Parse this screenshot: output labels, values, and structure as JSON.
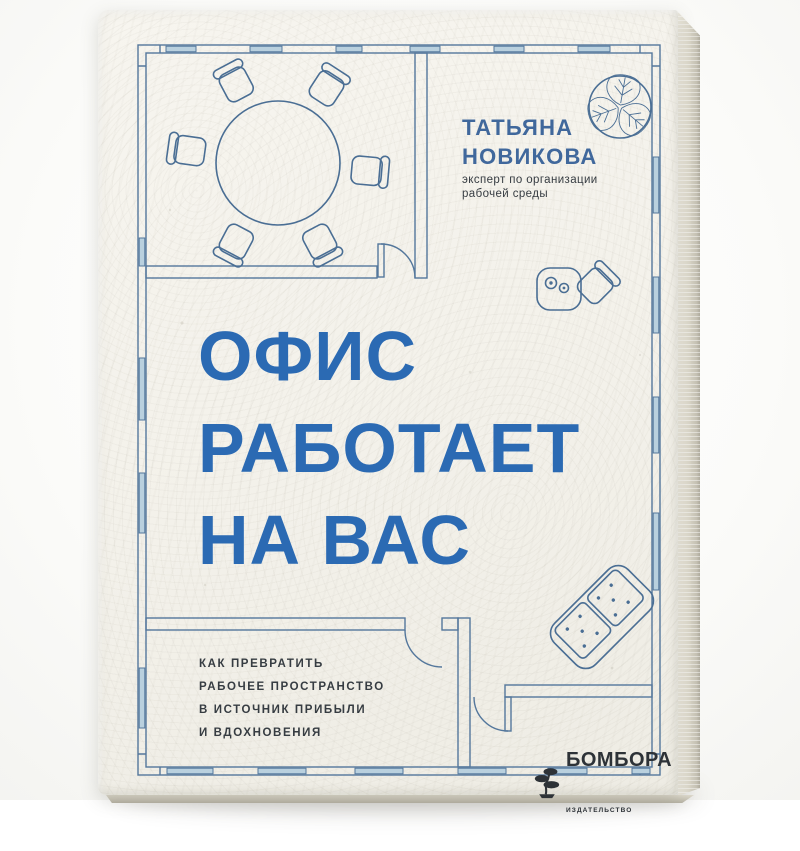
{
  "book_cover": {
    "author": {
      "name": [
        "ТАТЬЯНА",
        "НОВИКОВА"
      ],
      "role": [
        "эксперт по организации",
        "рабочей среды"
      ]
    },
    "title": [
      "ОФИС",
      "РАБОТАЕТ",
      "НА ВАС"
    ],
    "tagline": [
      "КАК ПРЕВРАТИТЬ",
      "РАБОЧЕЕ ПРОСТРАНСТВО",
      "В ИСТОЧНИК ПРИБЫЛИ",
      "И ВДОХНОВЕНИЯ"
    ],
    "publisher": {
      "name": "БОМБОРА",
      "descriptor": "ИЗДАТЕЛЬСТВО"
    },
    "colors": {
      "title_blue": "#2b6ab3",
      "author_blue": "#40689c",
      "plan_line": "#54779c",
      "furn_line": "#4a6e94",
      "window_fill": "#b9d0de",
      "text_dark": "#363c42",
      "publisher_dark": "#2d3237",
      "paper": "#f3f1ea"
    },
    "icons": [
      "plant-top-view-icon",
      "round-table-icon",
      "office-chair-icon",
      "desk-icon",
      "sofa-icon",
      "door-arc-icon",
      "window-icon",
      "publisher-bonsai-icon"
    ]
  }
}
